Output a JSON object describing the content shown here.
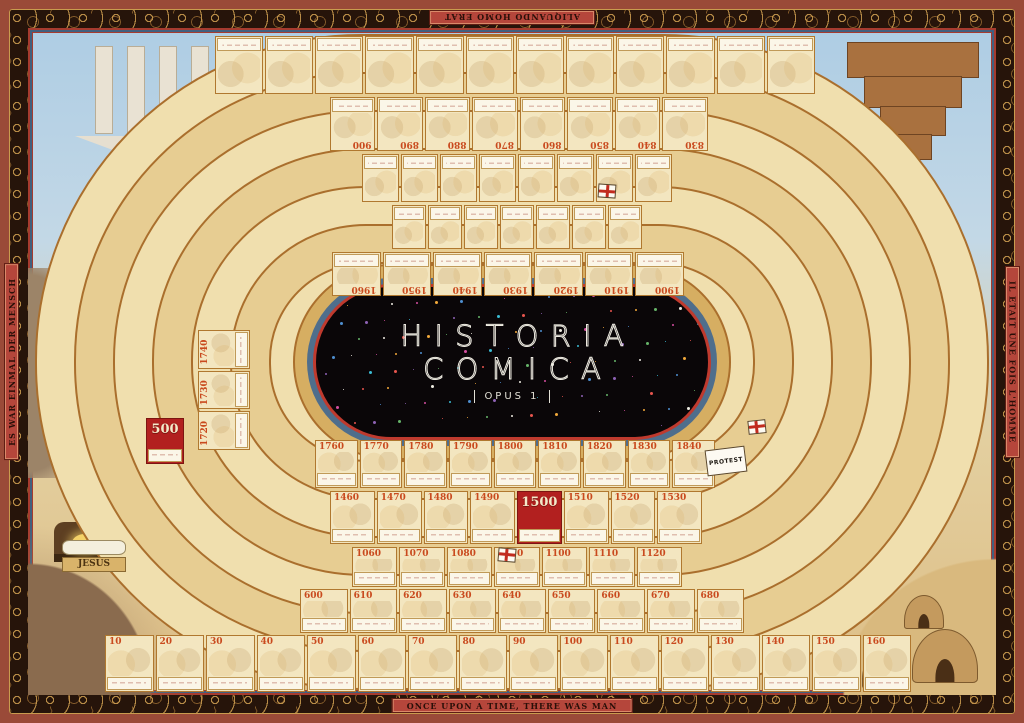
{
  "poster": {
    "title_line1": "HISTORIA",
    "title_line2": "COMICA",
    "subtitle": "OPUS 1"
  },
  "border_mottos": {
    "top_latin": "ALIQUANDO HOMO ERAT",
    "bottom_english": "ONCE UPON A TIME, THERE WAS MAN",
    "left_german": "ES WAR EINMAL DER MENSCH",
    "right_french": "IL ETAIT UNE FOIS L'HOMME"
  },
  "markers": {
    "protest_flag": "PROTEST",
    "jesus_plaque": "JESUS",
    "medallion_500": {
      "year": "500",
      "medallion": true
    }
  },
  "rows": {
    "outer_bottom_1st_2nd_century": [
      {
        "year": "10"
      },
      {
        "year": "20"
      },
      {
        "year": "30"
      },
      {
        "year": "40"
      },
      {
        "year": "50"
      },
      {
        "year": "60"
      },
      {
        "year": "70"
      },
      {
        "year": "80"
      },
      {
        "year": "90"
      },
      {
        "year": "100"
      },
      {
        "year": "110"
      },
      {
        "year": "120"
      },
      {
        "year": "130"
      },
      {
        "year": "140"
      },
      {
        "year": "150"
      },
      {
        "year": "160"
      }
    ],
    "seventh_century": [
      {
        "year": "600"
      },
      {
        "year": "610"
      },
      {
        "year": "620"
      },
      {
        "year": "630"
      },
      {
        "year": "640"
      },
      {
        "year": "650"
      },
      {
        "year": "660"
      },
      {
        "year": "670"
      },
      {
        "year": "680"
      }
    ],
    "twelfth_century": [
      {
        "year": "1060"
      },
      {
        "year": "1070"
      },
      {
        "year": "1080"
      },
      {
        "year": "1090"
      },
      {
        "year": "1100"
      },
      {
        "year": "1110"
      },
      {
        "year": "1120"
      }
    ],
    "sixteenth_century": [
      {
        "year": "1460"
      },
      {
        "year": "1470"
      },
      {
        "year": "1480"
      },
      {
        "year": "1490"
      },
      {
        "year": "1500",
        "medallion": true
      },
      {
        "year": "1510"
      },
      {
        "year": "1520"
      },
      {
        "year": "1530"
      }
    ],
    "nineteenth_century": [
      {
        "year": "1760"
      },
      {
        "year": "1770"
      },
      {
        "year": "1780"
      },
      {
        "year": "1790"
      },
      {
        "year": "1800"
      },
      {
        "year": "1810"
      },
      {
        "year": "1820"
      },
      {
        "year": "1830"
      },
      {
        "year": "1840"
      }
    ],
    "twentieth_century_inverted": [
      {
        "year": "1900"
      },
      {
        "year": "1910"
      },
      {
        "year": "1920"
      },
      {
        "year": "1930"
      },
      {
        "year": "1940"
      },
      {
        "year": "1950"
      },
      {
        "year": "1960"
      }
    ],
    "ninth_century_inverted": [
      {
        "year": "830"
      },
      {
        "year": "840"
      },
      {
        "year": "850"
      },
      {
        "year": "860"
      },
      {
        "year": "870"
      },
      {
        "year": "880"
      },
      {
        "year": "890"
      },
      {
        "year": "900"
      }
    ],
    "eighteenth_century_left": [
      {
        "year": "1720"
      },
      {
        "year": "1730"
      },
      {
        "year": "1740"
      }
    ]
  },
  "colors": {
    "frame_outer": "#9a4a38",
    "frame_dark": "#26140a",
    "frame_gold": "#c99b4e",
    "banner_red": "#b5463b",
    "sky": "#aecde4",
    "parchment": "#e7cd92",
    "cell_cream": "#f3e6c0",
    "ring_line": "#aa6f2d",
    "year_red": "#c94a1e",
    "medallion_red": "#b2201f",
    "center_black": "#0a0608",
    "center_rim_red": "#bf3a2e",
    "center_rim_blue": "#4f6e8c"
  },
  "star_colors": [
    "#e8554e",
    "#f2a93b",
    "#4f8fd0",
    "#8e62b5",
    "#67b56a",
    "#efece2",
    "#d44fa0",
    "#3bbcd4"
  ]
}
